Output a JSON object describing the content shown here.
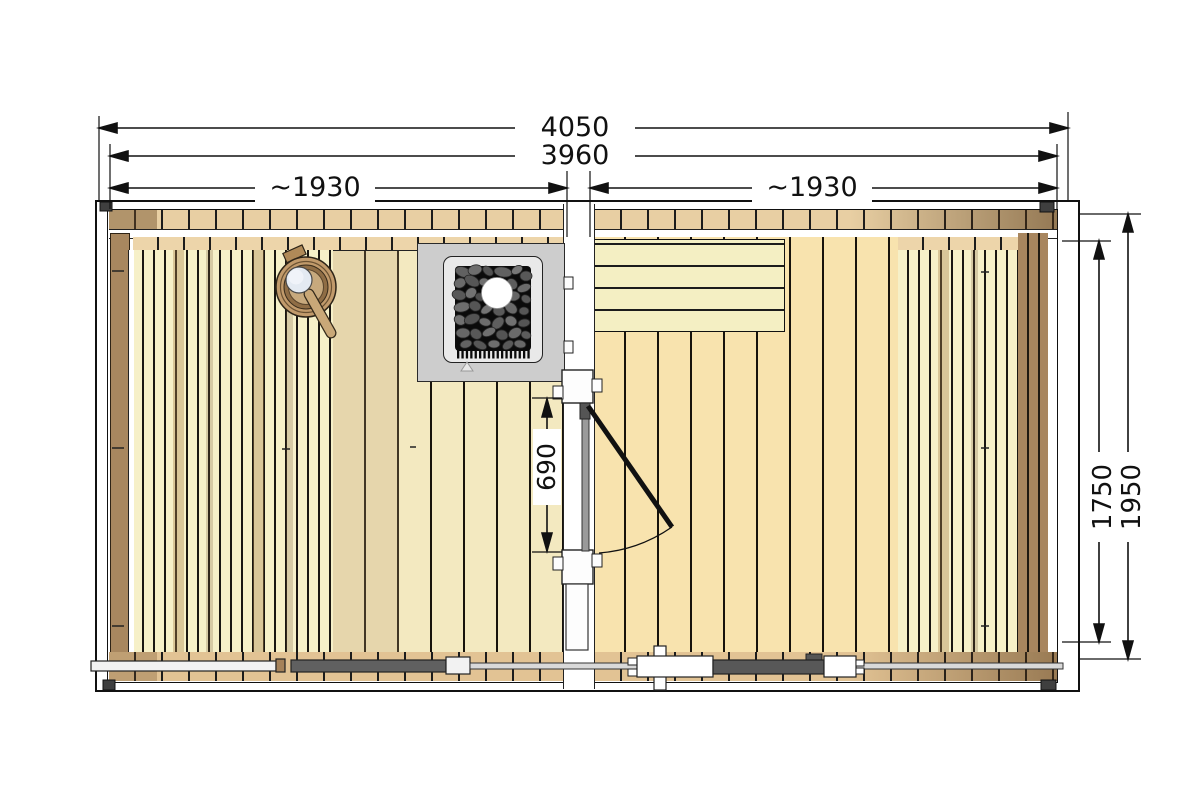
{
  "drawing": {
    "type": "sauna-cabin-floor-plan-top-view",
    "dimensions": {
      "overall_width": "4050",
      "frame_width": "3960",
      "left_section_width": "~1930",
      "right_section_width": "~1930",
      "inner_depth": "1750",
      "outer_depth": "1950",
      "door_opening": "690"
    },
    "components": {
      "heater": "sauna-heater-with-stones",
      "bucket": "water-bucket-with-ladle",
      "door": "hinged-door-with-swing-arc",
      "left_bench": "slatted-bench",
      "right_bench": "slatted-bench",
      "front_bench": "horizontal-plank-bench",
      "partition": "partition-wall",
      "rail": "front-wall-rail"
    },
    "colors": {
      "floor": "#F8E3AE",
      "floor_light": "#F3E9C0",
      "wall_plank": "#E8CFA3",
      "bench_slat": "#F6F0C8",
      "side_wall": "#A8875F",
      "stove_body": "#CDCDCD",
      "stones": "#0B0B0B",
      "ladle_cup": "#E4EAF2",
      "bucket_wood": "#C19A6B",
      "dimension_line": "#111111"
    }
  }
}
